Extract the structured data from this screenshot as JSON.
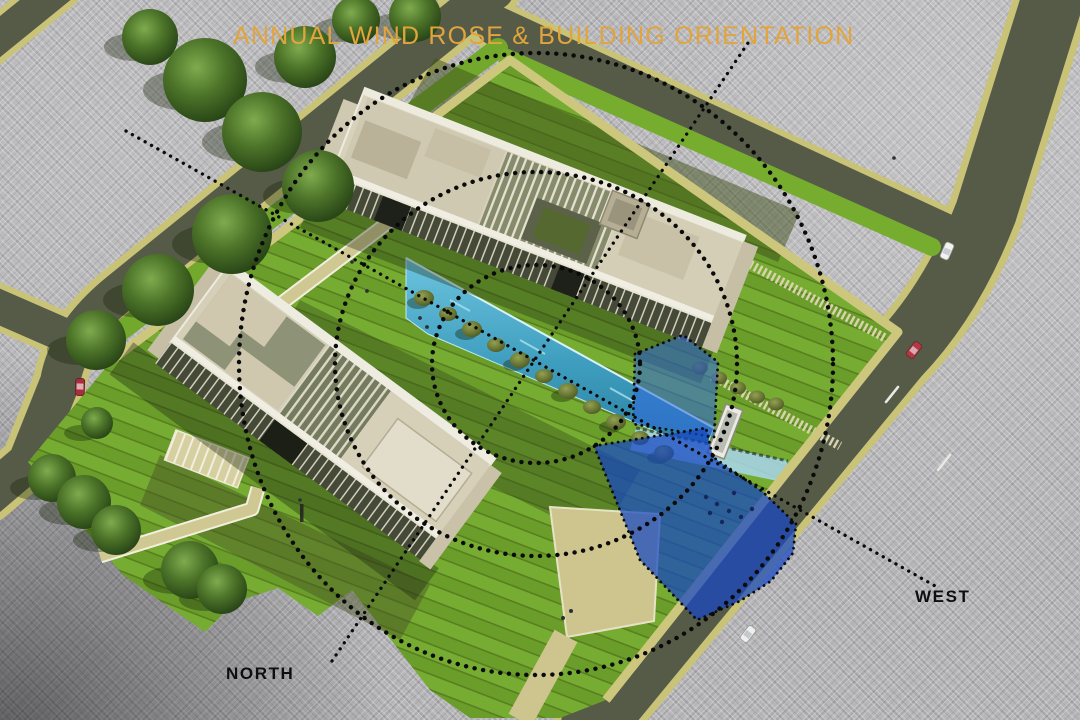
{
  "header": {
    "title": "ANNUAL WIND ROSE & BUILDING ORIENTATION",
    "title_color": "#E2A43C"
  },
  "compass_labels": {
    "north": "NORTH",
    "west": "WEST",
    "color": "#0E0E0E"
  },
  "wind_rose": {
    "ring_count": 3,
    "ring_style": "dotted-black",
    "axis_lines": [
      "north-axis",
      "west-axis"
    ],
    "sectors": [
      {
        "name": "primary-wind-sector",
        "color": "#1A49C8",
        "opacity": 0.72
      },
      {
        "name": "secondary-wind-sector",
        "color": "#2F68DE",
        "opacity": 0.55
      }
    ]
  },
  "palette": {
    "background_gray": "#B5B4B6",
    "road": "#565B48",
    "curb_tan": "#C9C378",
    "lawn_green": "#6FA02C",
    "building_roof": "#D6D0B9",
    "water_aqua": "#3E9DBE",
    "tree_green": "#3F6626",
    "title_orange": "#E2A43C"
  }
}
